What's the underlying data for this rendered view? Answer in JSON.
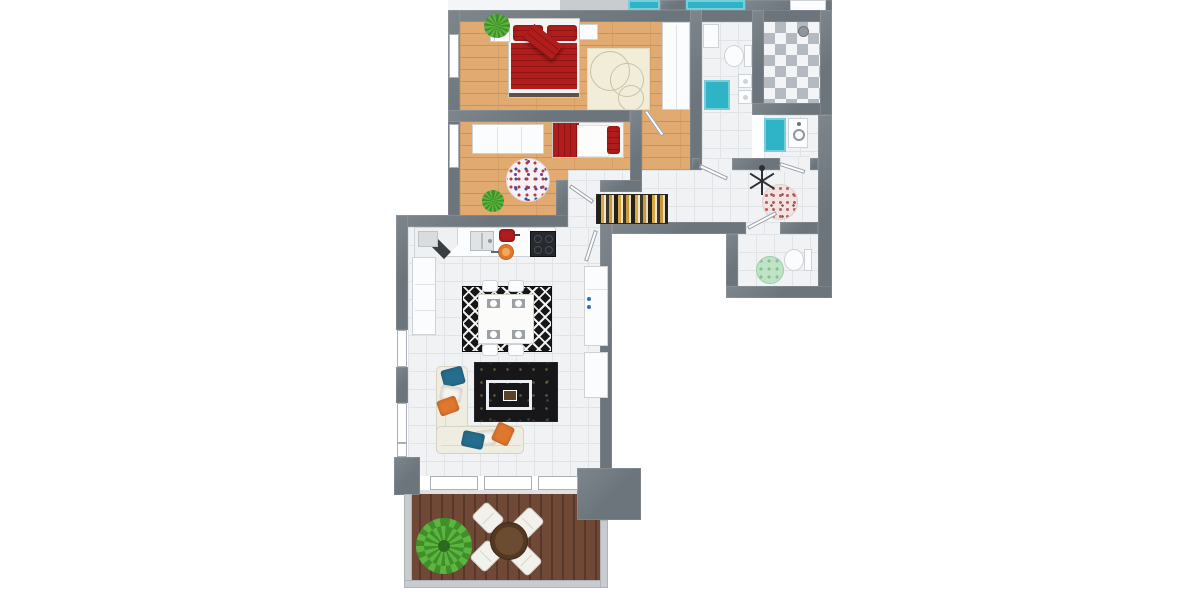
{
  "page": {
    "title": "3D Apartment Floor Plan",
    "background": "#ffffff"
  },
  "colors": {
    "wall": "#6d757c",
    "wood": "#e0aa70",
    "woodline": "#c9935a",
    "tile": "#f0f2f4",
    "tileline": "#e0e4e8",
    "deck": "#6f4836",
    "deckline": "#57382a",
    "checka": "#b4bac0",
    "checkb": "#f3f4f6",
    "teal": "#2fb4c7",
    "red": "#b11c1c",
    "reddark": "#911414",
    "blue": "#256d8d",
    "orange": "#e0772e",
    "sofa": "#efece2",
    "rugblack": "#17171a",
    "gold": "#d8a843",
    "plant": "#5cb53e",
    "plantdark": "#3f8f2a",
    "brown": "#5d4229",
    "matgreen": "#bfe3c4",
    "pinkdot": "#b5605e",
    "dotred": "#b23a48",
    "dotblue": "#3a4d9b",
    "dotpurple": "#7a3b8f",
    "fborder": "#cdd2d7"
  },
  "rooms": [
    {
      "id": "master-bedroom",
      "label": "Master Bedroom",
      "floor": "wood",
      "furniture": [
        "double-bed-red",
        "nightstand-left",
        "nightstand-right",
        "potted-plant",
        "circle-pattern-rug",
        "wardrobe"
      ]
    },
    {
      "id": "bedroom-2",
      "label": "Bedroom 2",
      "floor": "wood",
      "furniture": [
        "single-bed-red",
        "wardrobe",
        "multicolor-dot-rug",
        "potted-plant"
      ]
    },
    {
      "id": "bathroom",
      "label": "Bathroom",
      "floor": "tile",
      "furniture": [
        "toilet",
        "double-washbasin",
        "teal-bath-mat",
        "cabinet"
      ]
    },
    {
      "id": "shower-area",
      "label": "Shower",
      "floor": "checker-tile",
      "furniture": [
        "shower-head"
      ]
    },
    {
      "id": "laundry-room",
      "label": "Laundry",
      "floor": "tile",
      "furniture": [
        "washing-machine",
        "teal-bath-mat"
      ]
    },
    {
      "id": "hallway",
      "label": "Hallway",
      "floor": "tile",
      "furniture": [
        "striped-runner-rug",
        "pink-dot-round-rug",
        "coat-stand"
      ]
    },
    {
      "id": "wc",
      "label": "WC",
      "floor": "tile",
      "furniture": [
        "toilet",
        "green-round-mat"
      ]
    },
    {
      "id": "great-room",
      "label": "Kitchen / Dining / Living Room",
      "floor": "tile",
      "furniture": [
        "kitchen-counter",
        "corner-unit",
        "kitchen-sink",
        "stove",
        "red-pot",
        "orange-pan",
        "fridge",
        "sideboard",
        "dining-table",
        "dining-chairs-x4",
        "zigzag-rug",
        "l-shaped-sofa",
        "throw-pillows",
        "coffee-table",
        "black-pattern-rug"
      ]
    },
    {
      "id": "terrace",
      "label": "Terrace",
      "floor": "deck",
      "furniture": [
        "round-table",
        "lounge-chairs-x4",
        "palm-plant"
      ]
    }
  ]
}
